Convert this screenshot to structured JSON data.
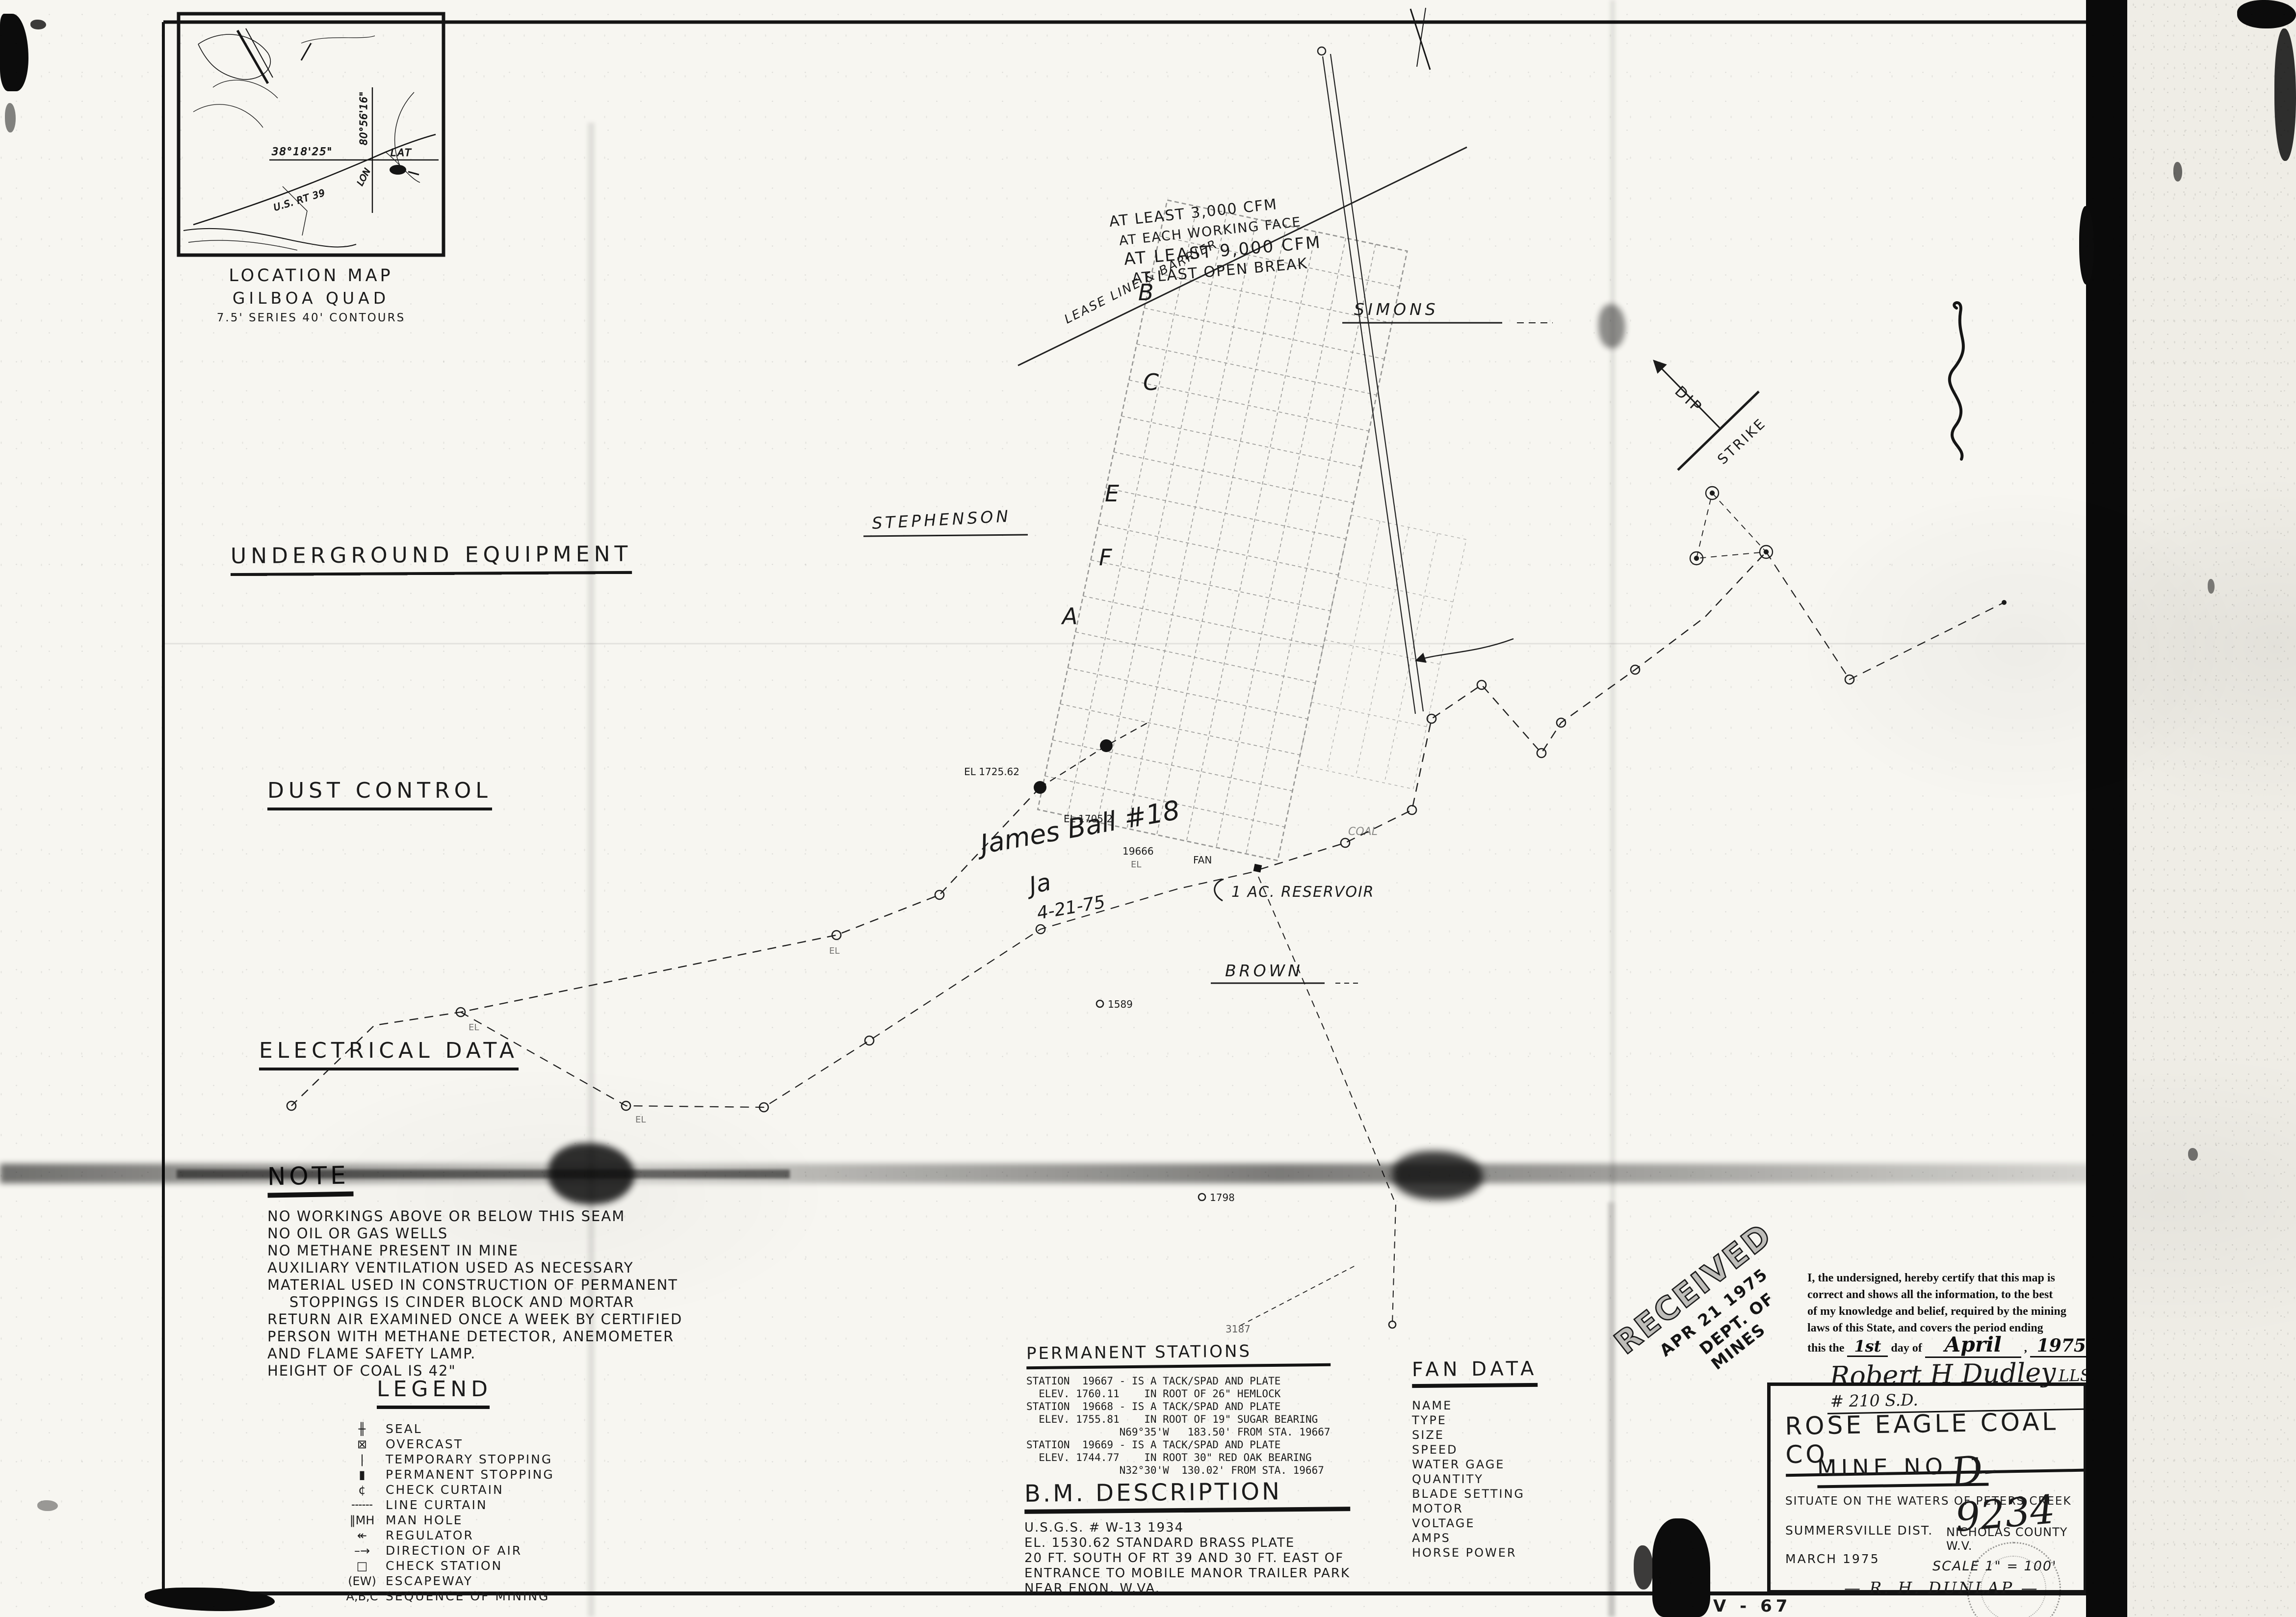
{
  "inset": {
    "caption1": "LOCATION MAP",
    "caption2": "GILBOA QUAD",
    "caption3": "7.5' SERIES 40' CONTOURS",
    "lat_value": "38°18'25\"",
    "lat_word": "LAT",
    "lon_value": "80°56'16\"",
    "lon_word": "LON",
    "route": "U.S. RT 39"
  },
  "headings": {
    "underground_equipment": "UNDERGROUND EQUIPMENT",
    "dust_control": "DUST CONTROL",
    "electrical_data": "ELECTRICAL DATA"
  },
  "note": {
    "title": "NOTE",
    "lines": [
      "NO WORKINGS ABOVE OR BELOW THIS SEAM",
      "NO OIL OR GAS WELLS",
      "NO METHANE PRESENT IN MINE",
      "AUXILIARY VENTILATION USED AS NECESSARY",
      "MATERIAL USED IN CONSTRUCTION OF PERMANENT",
      "    STOPPINGS IS CINDER BLOCK AND MORTAR",
      "RETURN AIR EXAMINED ONCE A WEEK BY CERTIFIED",
      "PERSON WITH METHANE DETECTOR, ANEMOMETER",
      "AND FLAME SAFETY LAMP.",
      "HEIGHT OF COAL IS 42\""
    ]
  },
  "legend": {
    "title": "LEGEND",
    "items": [
      {
        "glyph": "╫",
        "label": "SEAL"
      },
      {
        "glyph": "⊠",
        "label": "OVERCAST"
      },
      {
        "glyph": "|",
        "label": "TEMPORARY STOPPING"
      },
      {
        "glyph": "▮",
        "label": "PERMANENT STOPPING"
      },
      {
        "glyph": "¢",
        "label": "CHECK CURTAIN"
      },
      {
        "glyph": "╌╌╌",
        "label": "LINE CURTAIN"
      },
      {
        "glyph": "‖MH",
        "label": "MAN HOLE"
      },
      {
        "glyph": "↞",
        "label": "REGULATOR"
      },
      {
        "glyph": "–→",
        "label": "DIRECTION OF AIR"
      },
      {
        "glyph": "□",
        "label": "CHECK STATION"
      },
      {
        "glyph": "(EW)",
        "label": "ESCAPEWAY"
      },
      {
        "glyph": "A,B,C",
        "label": "SEQUENCE OF MINING"
      }
    ]
  },
  "stations": {
    "title": "PERMANENT STATIONS",
    "lines": [
      "STATION  19667 - IS A TACK/SPAD AND PLATE",
      "  ELEV. 1760.11    IN ROOT OF 26\" HEMLOCK",
      "STATION  19668 - IS A TACK/SPAD AND PLATE",
      "  ELEV. 1755.81    IN ROOT OF 19\" SUGAR BEARING",
      "               N69°35'W   183.50' FROM STA. 19667",
      "STATION  19669 - IS A TACK/SPAD AND PLATE",
      "  ELEV. 1744.77    IN ROOT 30\" RED OAK BEARING",
      "               N32°30'W  130.02' FROM STA. 19667"
    ]
  },
  "bm": {
    "title": "B.M. DESCRIPTION",
    "lines": [
      "U.S.G.S. # W-13 1934",
      "EL. 1530.62 STANDARD BRASS PLATE",
      "20 FT. SOUTH OF RT 39 AND 30 FT. EAST OF",
      "ENTRANCE TO MOBILE MANOR TRAILER PARK",
      "NEAR ENON, W.VA."
    ]
  },
  "fan": {
    "title": "FAN DATA",
    "fields": [
      "NAME",
      "TYPE",
      "SIZE",
      "SPEED",
      "WATER GAGE",
      "QUANTITY",
      "BLADE SETTING",
      "MOTOR",
      "VOLTAGE",
      "AMPS",
      "HORSE POWER"
    ]
  },
  "cert": {
    "lines": [
      "I, the undersigned, hereby certify that this map is",
      "correct and shows all the information, to the best",
      "of my knowledge and belief, required by the mining",
      "laws of this State, and covers the period ending"
    ],
    "prefix": "this the",
    "day": "1st",
    "mid": "day of",
    "month": "April",
    "comma": ",",
    "year": "1975",
    "period": ".",
    "signature": "Robert H Dudley",
    "license": "LLS # 210 S.D."
  },
  "stamp": {
    "received": "RECEIVED",
    "date": "APR 21 1975",
    "dept": "DEPT. OF MINES"
  },
  "titleblock": {
    "company": "ROSE EAGLE COAL CO.",
    "mine": "MINE NO. 1",
    "map_no": "D-9234",
    "situate": "SITUATE ON THE WATERS OF PETERS CREEK",
    "district": "SUMMERSVILLE DIST.",
    "county": "NICHOLAS COUNTY W.V.",
    "date": "MARCH 1975",
    "scale": "SCALE 1\" = 100'",
    "engineer": "R. H. DUNLAP"
  },
  "map_labels": {
    "lease_line": "LEASE LINE & BARRIER",
    "cfm_face_1": "AT LEAST 3,000 CFM",
    "cfm_face_2": "AT EACH WORKING FACE",
    "cfm_break_1": "AT LEAST 9,000 CFM",
    "cfm_break_2": "AT LAST OPEN BREAK",
    "simons": "SIMONS",
    "stephenson": "STEPHENSON",
    "brown": "BROWN",
    "reservoir": "1 AC. RESERVOIR",
    "fan": "FAN",
    "coal": "COAL",
    "dip": "DIP",
    "strike": "STRIKE",
    "letters": [
      "B",
      "C",
      "E",
      "F",
      "A"
    ],
    "hand_name": "James Ball #18",
    "hand_initials": "Ja",
    "hand_date": "4-21-75",
    "el_1725": "EL 1725.62",
    "el_1705": "EL 1705.2",
    "sta_19666": "19666",
    "el_short": "EL",
    "num_3187": "3187",
    "pt_1589": "1589",
    "pt_1798": "1798",
    "sheet_no": "V - 67"
  }
}
